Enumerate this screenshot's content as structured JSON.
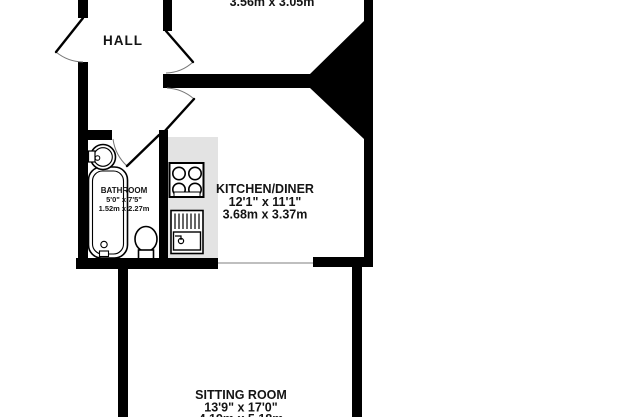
{
  "rooms": {
    "hall": {
      "name": "HALL"
    },
    "top_room": {
      "metric": "3.56m x 3.05m"
    },
    "kitchen_diner": {
      "name": "KITCHEN/DINER",
      "imperial": "12'1\" x 11'1\"",
      "metric": "3.68m x 3.37m"
    },
    "bathroom": {
      "name": "BATHROOM",
      "imperial": "5'0\" x 7'5\"",
      "metric": "1.52m x 2.27m"
    },
    "sitting_room": {
      "name": "SITTING ROOM",
      "imperial": "13'9\" x 17'0\"",
      "metric": "4.19m x 5.18m"
    }
  },
  "fixture_icons": [
    "bathtub-icon",
    "washbasin-icon",
    "toilet-icon",
    "hob-icon",
    "kitchen-sink-icon",
    "door-swing-icon"
  ],
  "colors": {
    "wall": "#000000",
    "counter": "#e3e3e3",
    "door_arc": "#777777",
    "open_boundary": "#999999",
    "text": "#141414",
    "background": "#ffffff"
  }
}
